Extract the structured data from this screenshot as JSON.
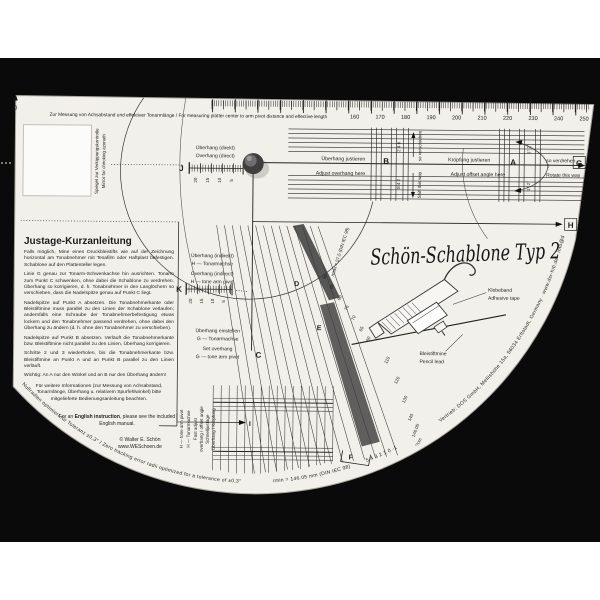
{
  "title": "Schön-Schablone Typ 2",
  "top": {
    "zero": "0",
    "caption": "Zur Messung von Achsabstand und effektiver Tonarmlänge / For measuring platter center to arm pivot distance and effective length",
    "ticks": [
      "160",
      "170",
      "180",
      "190",
      "200",
      "210",
      "220",
      "230",
      "240",
      "250"
    ]
  },
  "mirror": {
    "de": "Spiegel zur Verkippungskontrolle",
    "en": "Mirror for checking azimuth"
  },
  "scaleJ": {
    "letter": "J",
    "de": "Überhang (direkt)",
    "en": "Overhang (direct)",
    "nums": [
      "20",
      "15",
      "10",
      "5"
    ]
  },
  "scaleK": {
    "letter": "K",
    "de": "Überhang (indirekt)",
    "de2": "H — Tonarmachse",
    "en": "Overhang (indirect)",
    "en2": "H — tone arm pivot",
    "nums": [
      "20",
      "15",
      "10",
      "5"
    ]
  },
  "setOverhang": {
    "de1": "Überhang einstellen",
    "de2": "G — Tonarmachse",
    "en1": "Set overhang",
    "en2": "G — tone arm pivot"
  },
  "adjustB": {
    "letter": "B",
    "de": "Überhang justieren",
    "en": "Adjust overhang here",
    "vert_de": "so verschieben",
    "vert_en": "Shift this way",
    "numsTop": "2 4 6",
    "numsBottom": "8 4 2"
  },
  "adjustA": {
    "letter": "A",
    "de": "Kröpfung justieren",
    "en": "Adjust offset angle here",
    "vert_de": "so verdrehen",
    "vert_en": "Rotate this way",
    "degTop": "1° 2°",
    "degBottom": "1° 2°"
  },
  "points": {
    "C": "C",
    "D": "D",
    "E": "E",
    "F": "F",
    "G": "G",
    "H": "H",
    "I": "I"
  },
  "fastAdjust": {
    "de1": "Schnelljustage",
    "de2": "Überhang / Kröpfung",
    "de3": "H — Tonarmachse",
    "en1": "Fast adjust",
    "en2": "overhang / offset angle",
    "en3": "H — tone arm pivot"
  },
  "cartridge": {
    "tape_de": "Klebeband",
    "tape_en": "Adhesive tape",
    "lead_de": "Bleistiftmine",
    "lead_en": "Pencil lead"
  },
  "arc": {
    "left": "Nullradien optimiert für Toleranz ±0,3°   /   Zero tracking error radii optimized for a tolerance of ±0,3°",
    "rmin": "rmin = 146.05 mm (DIN IEC 98)",
    "rmax": "rmax = 57,5 (DIN IEC 98)",
    "tracking": "5   4   3   2   1   0   -1",
    "unit": "°/cm",
    "right": "Vertrieb: DOS GmbH, Mellishöhe 15a, 56034 Erftstadt, Germany  ·  www.dsr-hifi.de  ·  info@dsr-hifi.de"
  },
  "radiusScale1": [
    "90",
    "85",
    "80",
    "75",
    "70",
    "65",
    "60"
  ],
  "radiusScale2": [
    "110",
    "120",
    "130",
    "140",
    "146.05"
  ],
  "instructions": {
    "heading": "Justage-Kurzanleitung",
    "p1": "Falls möglich, Mine eines Druckbleistifts wie auf der Zeichnung horizontal am Tonabnehmer mit Tesafilm oder Haftplast befestigen. Schablone auf den Plattenteller legen.",
    "p2": "Linie G genau zur Tonarm-Schwenkachse hin ausrichten. Tonarm zum Punkt C schwenken, ohne dabei die Schablone zu verdrehen. Überhang so korrigieren, d. h. Tonabnehmer in den Langlöchern so verschieben, dass die Nadelspitze genau auf Punkt C liegt.",
    "p3": "Nadelspitze auf Punkt A absetzen. Die Tonabnehmerkante oder Bleistiftmine muss parallel zu den Linien der Schablone verlaufen; andernfalls eine Schraube der Tonabnehmerbefestigung etwas lockern und den Tonabnehmer passend verdrehen, ohne dabei den Überhang zu ändern (d. h. ohne den Tonabnehmer zu verschieben).",
    "p4": "Nadelspitze auf Punkt B absetzen. Verläuft die Tonabnehmerkante bzw. Bleistiftmine nicht parallel zu den Linien, Überhang korrigieren.",
    "p5": "Schritte 2 und 3 wiederholen, bis die Tonabnehmerkante bzw. Bleistiftmine an Punkt A und an Punkt B parallel zu den Linien verläuft.",
    "p6": "Wichtig: An A nur den Winkel und an B nur den Überhang ändern!",
    "p7": "Für weitere Informationen (zur Messung von Achsabstand, Tonarmlänge, Überhang u. relativem Spurfehlwinkel) bitte mitgelieferte Bedienungsanleitung beachten.",
    "en_pre": "For an ",
    "en_bold": "English instruction",
    "en_post": ", please see the included English manual.",
    "copyright": "©  Walter E. Schön",
    "site": "www.WESchoen.de"
  }
}
